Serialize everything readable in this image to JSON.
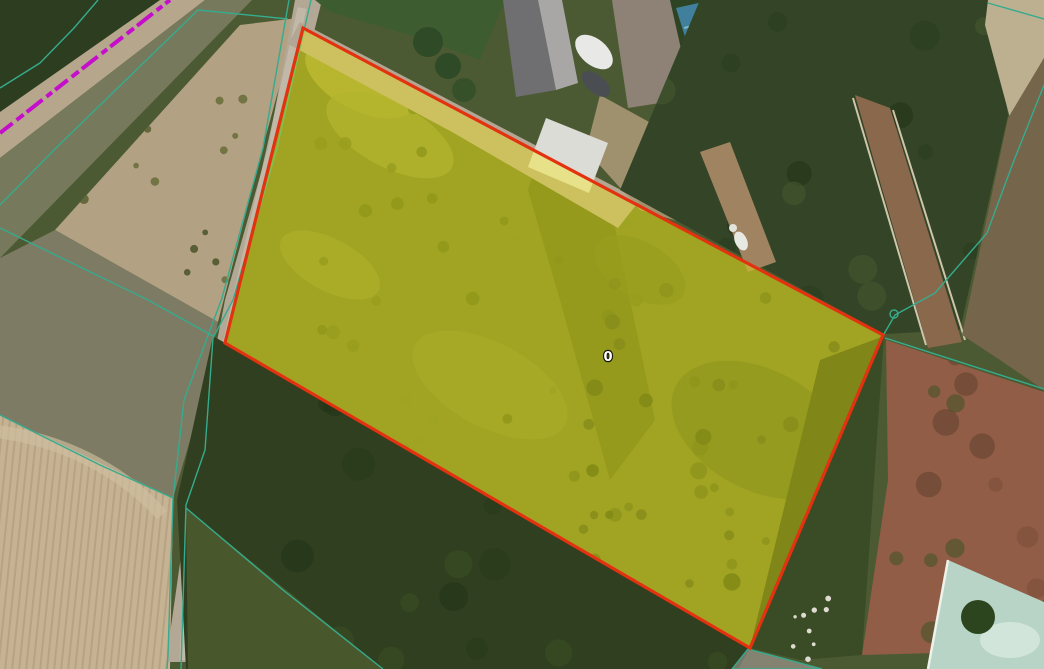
{
  "app": {
    "view": "cadastral-satellite-map"
  },
  "map": {
    "parcel_label": "0",
    "colors": {
      "parcel_stroke": "#e23210",
      "parcel_fill": "#fcee00",
      "parcel_fill_opacity": 0.36,
      "cadastral_line": "#36ab8d",
      "magenta_line": "#c50ecb",
      "label_color": "#ffffff",
      "neighbor_fill": "#b2a4a2"
    },
    "selected_parcel": {
      "points": [
        [
          303,
          28
        ],
        [
          883,
          335
        ],
        [
          750,
          648
        ],
        [
          225,
          343
        ]
      ],
      "label": "0",
      "label_pos": [
        608,
        356
      ]
    },
    "cadastral_lines": [
      {
        "name": "road-west-line",
        "points": [
          [
            289,
            0
          ],
          [
            263,
            148
          ],
          [
            222,
            298
          ],
          [
            184,
            400
          ],
          [
            173,
            498
          ],
          [
            168,
            655
          ],
          [
            167,
            669
          ]
        ]
      },
      {
        "name": "road-east-line",
        "points": [
          [
            311,
            0
          ],
          [
            277,
            148
          ],
          [
            233,
            300
          ],
          [
            213,
            338
          ],
          [
            205,
            450
          ],
          [
            186,
            505
          ],
          [
            181,
            669
          ]
        ]
      },
      {
        "name": "field-boundary-upper-west",
        "points": [
          [
            0,
            228
          ],
          [
            148,
            300
          ],
          [
            213,
            336
          ]
        ]
      },
      {
        "name": "field-boundary-lower-west",
        "points": [
          [
            0,
            415
          ],
          [
            100,
            465
          ],
          [
            173,
            498
          ]
        ]
      },
      {
        "name": "boundary-southeast-branch",
        "points": [
          [
            186,
            508
          ],
          [
            283,
            590
          ],
          [
            383,
            669
          ]
        ]
      },
      {
        "name": "boundary-northeast",
        "points": [
          [
            1044,
            85
          ],
          [
            1013,
            163
          ],
          [
            987,
            233
          ],
          [
            935,
            293
          ],
          [
            895,
            315
          ],
          [
            884,
            334
          ]
        ]
      },
      {
        "name": "boundary-topright-corner",
        "points": [
          [
            988,
            3
          ],
          [
            1044,
            19
          ]
        ]
      },
      {
        "name": "boundary-east",
        "points": [
          [
            885,
            338
          ],
          [
            1044,
            389
          ]
        ]
      },
      {
        "name": "boundary-topleft",
        "points": [
          [
            98,
            0
          ],
          [
            74,
            28
          ],
          [
            40,
            63
          ],
          [
            0,
            88
          ]
        ]
      },
      {
        "name": "boundary-along-road-northwest",
        "points": [
          [
            0,
            205
          ],
          [
            57,
            147
          ],
          [
            198,
            10
          ],
          [
            288,
            19
          ]
        ]
      }
    ],
    "neighbor_parcel": {
      "points": [
        [
          732,
          669
        ],
        [
          748,
          649
        ],
        [
          822,
          669
        ]
      ]
    },
    "restriction_line": {
      "points": [
        [
          0,
          133
        ],
        [
          170,
          0
        ]
      ],
      "dash": "16 5 9 4 20 5 7 4",
      "width": 4
    },
    "vertex_marker": {
      "cx": 894,
      "cy": 314,
      "r": 4
    }
  }
}
